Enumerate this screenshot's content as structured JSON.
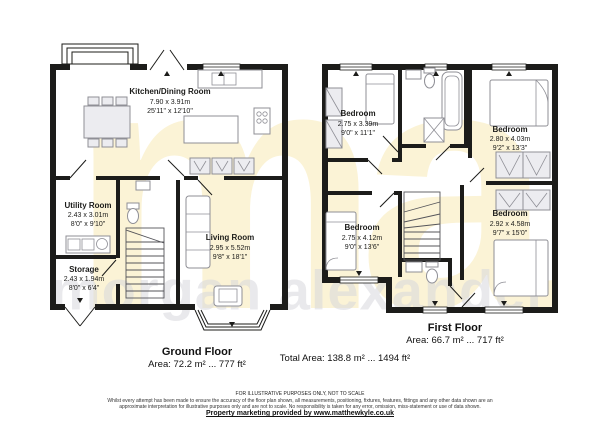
{
  "watermark": {
    "monogram": "ma",
    "text": "morgan alexander"
  },
  "ground_floor": {
    "label": "Ground Floor",
    "area": "Area: 72.2 m² ... 777 ft²",
    "rooms": [
      {
        "name": "Kitchen/Dining Room",
        "metric": "7.90 x 3.91m",
        "imperial": "25'11\" x 12'10\""
      },
      {
        "name": "Utility Room",
        "metric": "2.43 x 3.01m",
        "imperial": "8'0\" x 9'10\""
      },
      {
        "name": "Storage",
        "metric": "2.43 x 1.94m",
        "imperial": "8'0\" x 6'4\""
      },
      {
        "name": "Living Room",
        "metric": "2.95 x 5.52m",
        "imperial": "9'8\" x 18'1\""
      }
    ]
  },
  "first_floor": {
    "label": "First Floor",
    "area": "Area: 66.7 m² ... 717 ft²",
    "rooms": [
      {
        "name": "Bedroom",
        "metric": "2.75 x 3.39m",
        "imperial": "9'0\" x 11'1\""
      },
      {
        "name": "Bedroom",
        "metric": "2.80 x 4.03m",
        "imperial": "9'2\" x 13'3\""
      },
      {
        "name": "Bedroom",
        "metric": "2.75 x 4.12m",
        "imperial": "9'0\" x 13'6\""
      },
      {
        "name": "Bedroom",
        "metric": "2.92 x 4.58m",
        "imperial": "9'7\" x 15'0\""
      }
    ]
  },
  "total_area_label": "Total Area: 138.8 m² ... 1494 ft²",
  "footer": {
    "notice": "FOR ILLUSTRATIVE PURPOSES ONLY, NOT TO SCALE",
    "disclaimer_line1": "Whilst every attempt has been made to ensure the accuracy of the floor plan shown, all measurements, positioning, fixtures, features, fittings and any other data shown are an",
    "disclaimer_line2": "approximate interpretation for illustrative purposes only and are not to scale. No responsibility is taken for any error, omission, miss-statement or use of data shown.",
    "marketing": "Property marketing provided by www.matthewkyle.co.uk"
  },
  "palette": {
    "wall": "#1c1c1a",
    "watermark_yellow": "#fbf3d6",
    "watermark_gray": "#d8d8dd",
    "furniture_stroke": "#8f8f96"
  }
}
